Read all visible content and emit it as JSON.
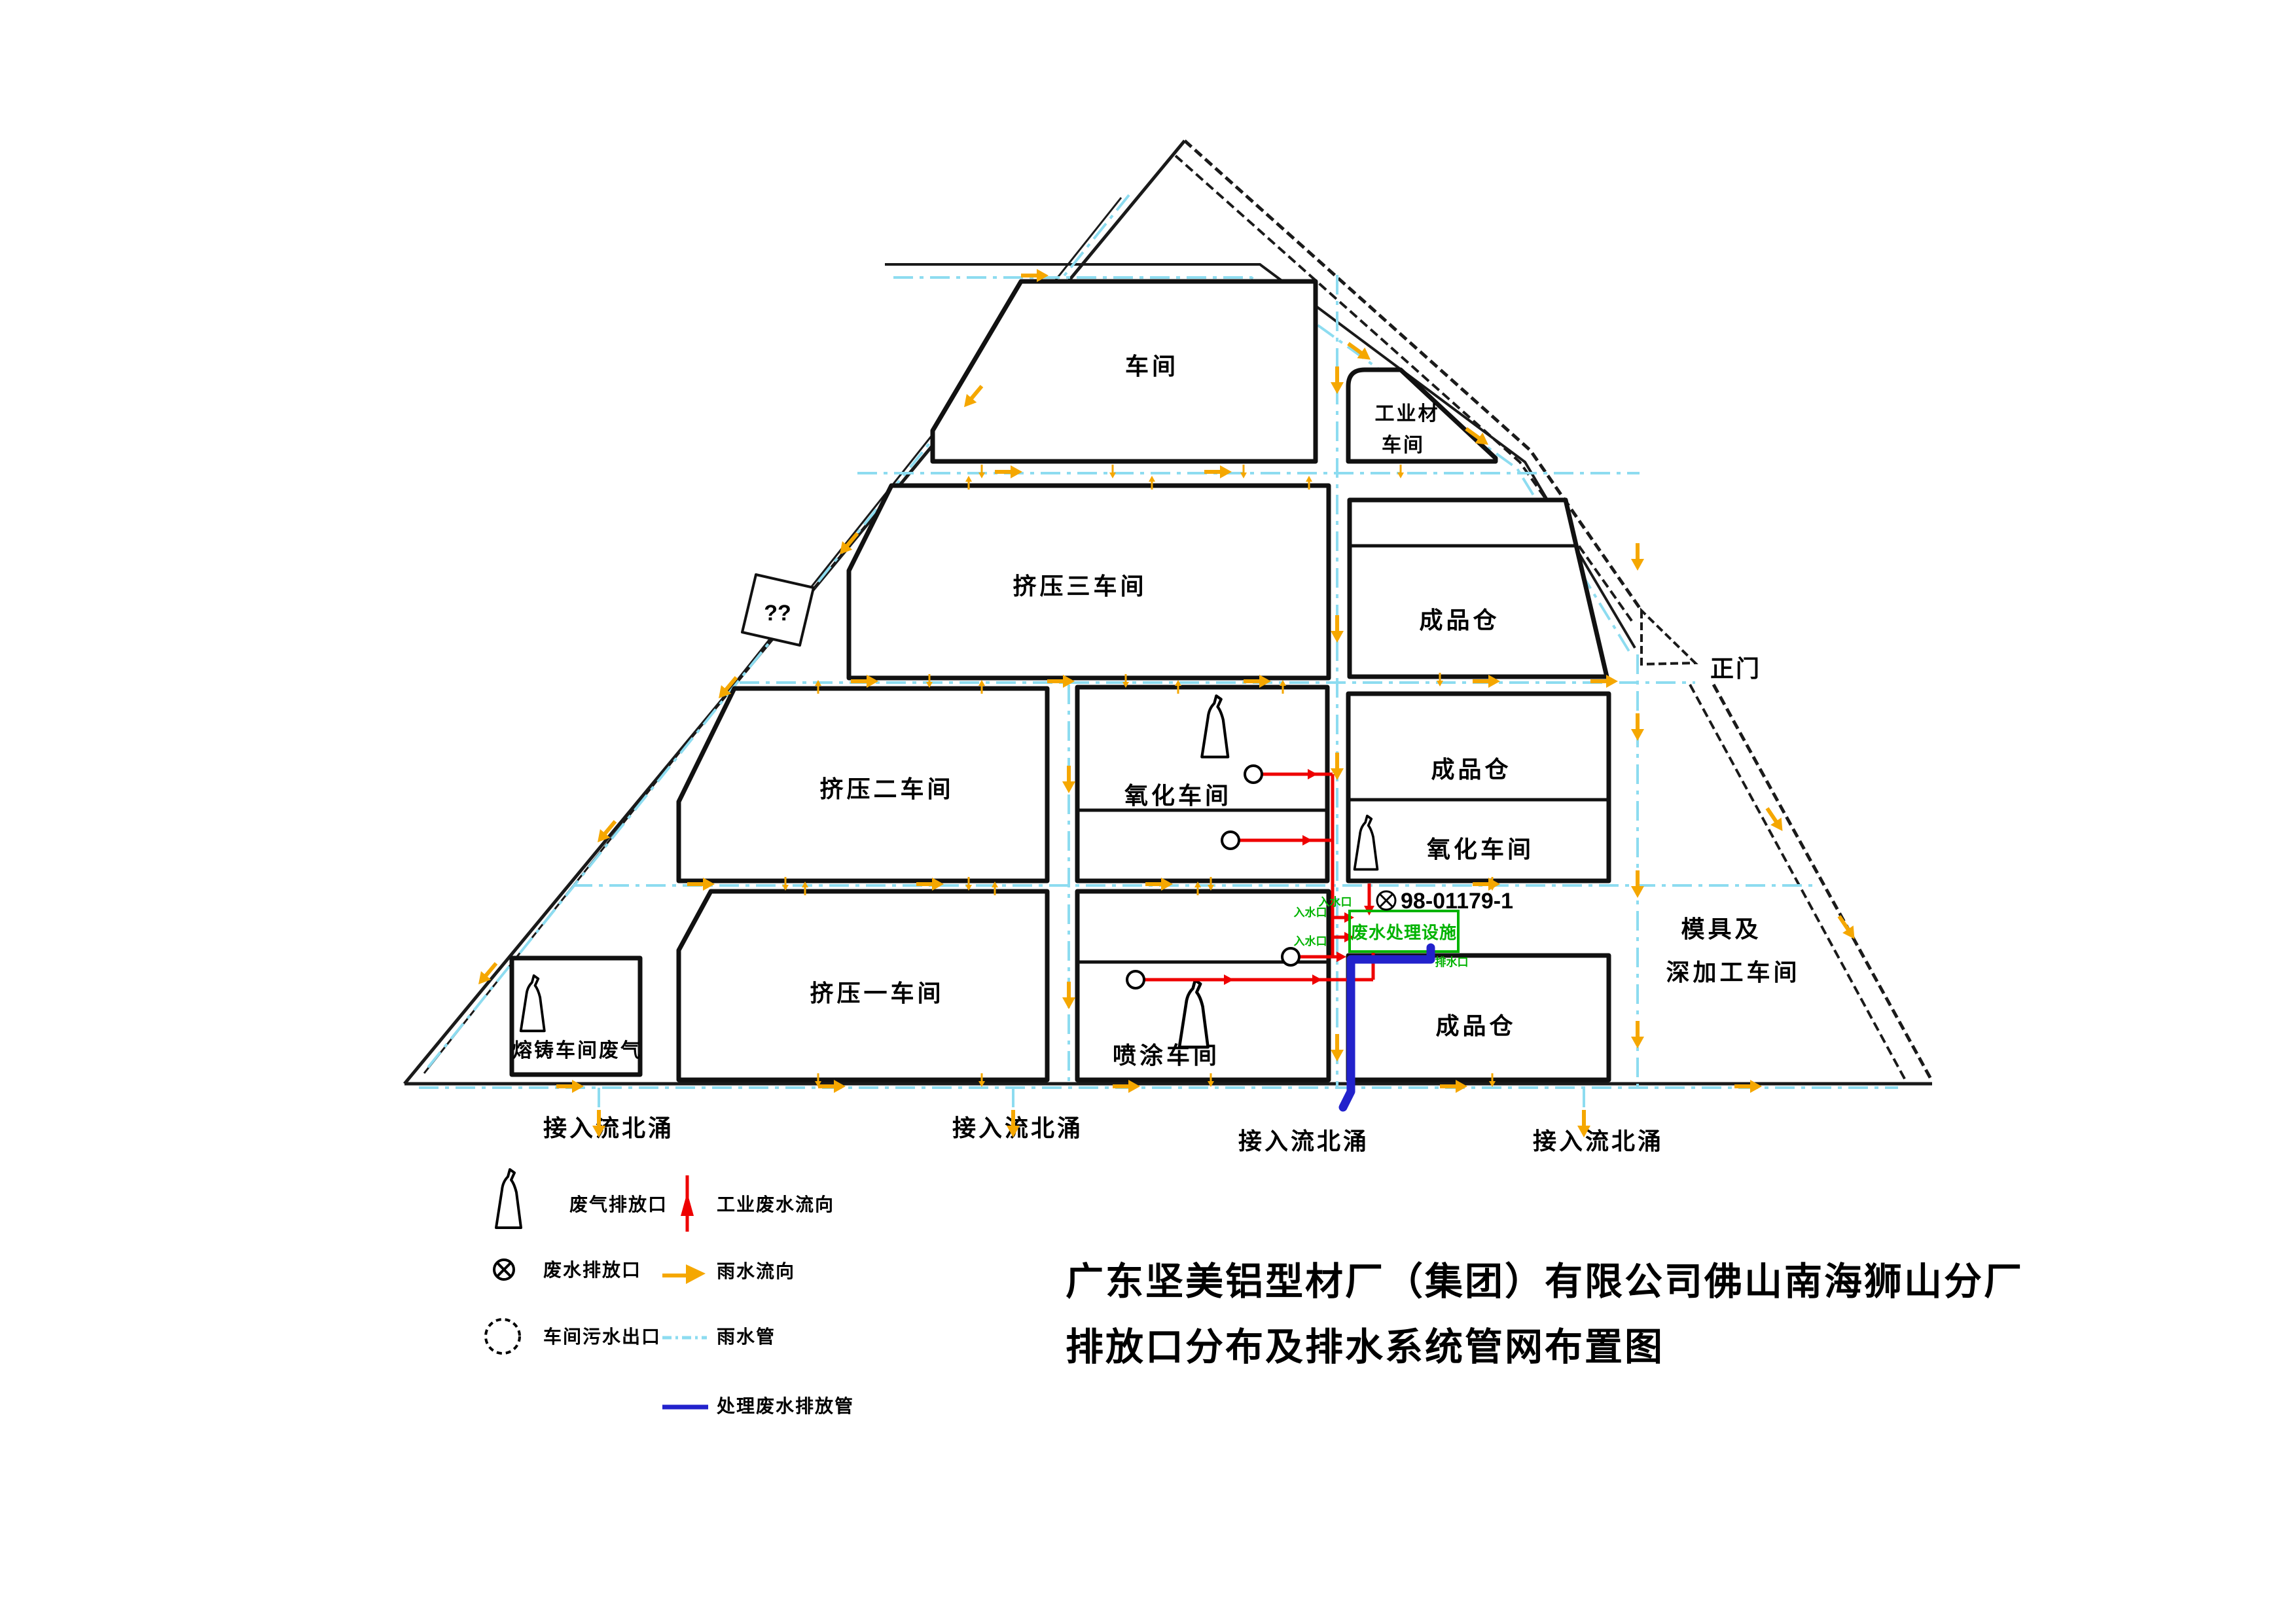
{
  "title": {
    "line1": "广东坚美铝型材厂（集团）有限公司佛山南海狮山分厂",
    "line2": "排放口分布及排水系统管网布置图"
  },
  "map": {
    "gate_label": "正门",
    "unknown_label": "??",
    "outfall_labels": [
      "接入流北涌",
      "接入流北涌",
      "接入流北涌",
      "接入流北涌"
    ],
    "buildings": {
      "workshop": "车间",
      "industrial_material_line1": "工业材",
      "industrial_material_line2": "车间",
      "extrusion_3": "挤压三车间",
      "finished_store_1": "成品仓",
      "extrusion_2": "挤压二车间",
      "oxidation_1": "氧化车间",
      "finished_store_2": "成品仓",
      "oxidation_2": "氧化车间",
      "extrusion_1": "挤压一车间",
      "spray": "喷涂车间",
      "finished_store_3": "成品仓",
      "melting": "熔铸车间废气",
      "mold_line1": "模具及",
      "mold_line2": "深加工车间"
    },
    "treatment": {
      "discharge_id": "98-01179-1",
      "facility": "废水处理设施",
      "inlet_label_1": "入水口",
      "inlet_label_2": "入水口",
      "inlet_label_3": "入水口",
      "outlet_label": "排水口"
    }
  },
  "legend": {
    "waste_gas_outlet": "废气排放口",
    "waste_water_outlet": "废水排放口",
    "workshop_sewage_outlet": "车间污水出口",
    "industrial_flow": "工业废水流向",
    "rain_flow": "雨水流向",
    "rain_pipe": "雨水管",
    "treated_pipe": "处理废水排放管"
  },
  "colors": {
    "industrial_red": "#ee0000",
    "rain_orange": "#f5a700",
    "rain_cyan": "#8ddcf0",
    "treated_blue": "#2222cc",
    "facility_green": "#00b300"
  }
}
